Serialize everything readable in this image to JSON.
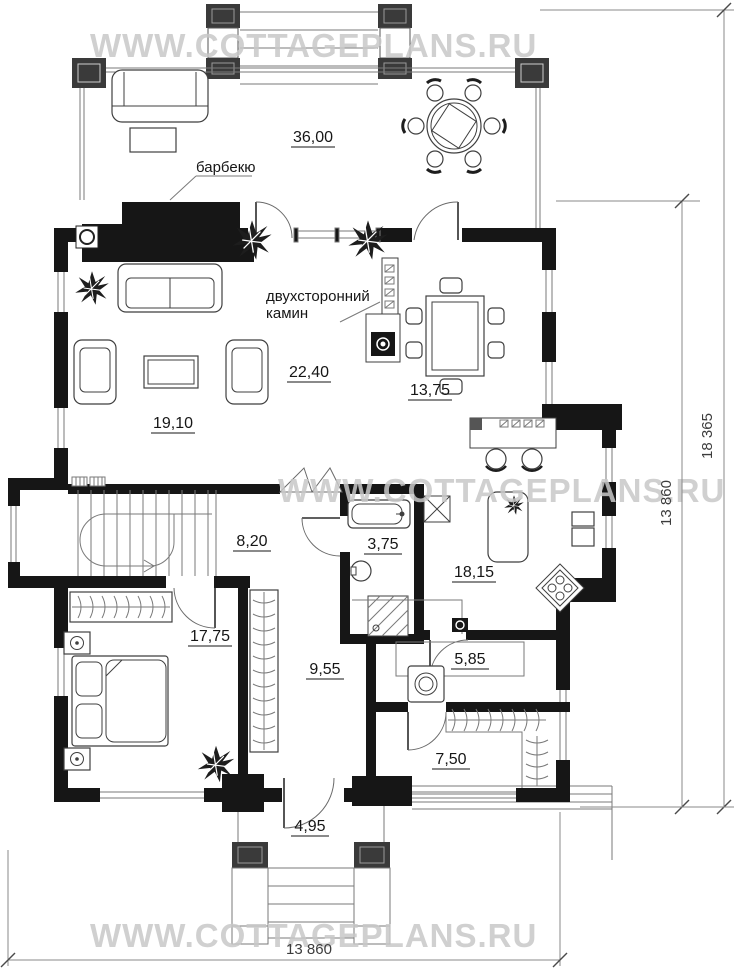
{
  "watermark": {
    "text": "WWW.COTTAGEPLANS.RU"
  },
  "rooms": {
    "terrace": "36,00",
    "living": "19,10",
    "fireplace_hall": "22,40",
    "dining": "13,75",
    "stair_hall": "8,20",
    "bathroom": "3,75",
    "kitchen": "18,15",
    "bedroom": "17,75",
    "hallway": "9,55",
    "laundry": "5,85",
    "wardrobe_room": "7,50",
    "porch": "4,95"
  },
  "annotations": {
    "barbecue": "барбекю",
    "fireplace_line1": "двухсторонний",
    "fireplace_line2": "камин"
  },
  "dimensions": {
    "right_outer": "18 365",
    "right_inner": "13 860",
    "bottom": "13 860"
  },
  "colors": {
    "wall": "#161616",
    "watermark": "#c8c8c8"
  }
}
